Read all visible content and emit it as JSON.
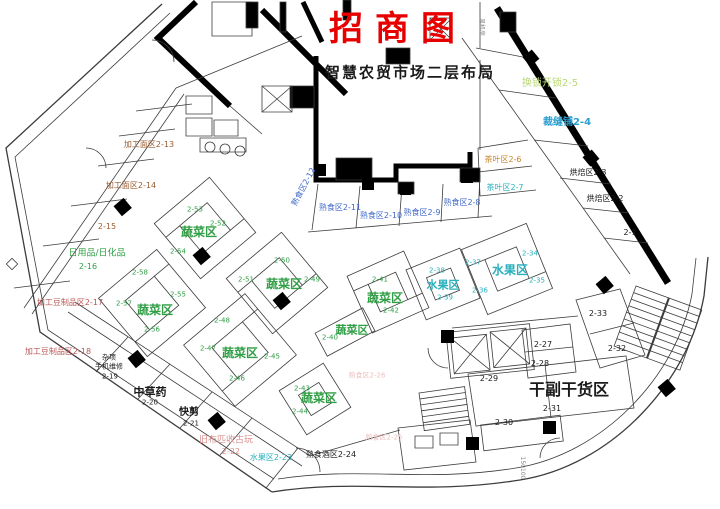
{
  "document": {
    "title": "招商图",
    "subtitle": "智慧农贸市场二层布局",
    "type": "market-floor-plan"
  },
  "colors": {
    "title_red": "#e60000",
    "vegetable_green": "#2f9e44",
    "fruit_cyan": "#29b0bd",
    "cooked_food_blue": "#4069c8",
    "tea_orange": "#c8862a",
    "lockshop_palegreen": "#b9d877",
    "noodle_brown": "#9a5b30",
    "tofu_crimson": "#bb5454",
    "cloth_pink": "#d98f8f",
    "faint_pink": "#eec0c0",
    "ink": "#1a1a1a"
  },
  "labels": [
    {
      "n": "page-title",
      "t": "招商图",
      "x": 398,
      "y": 29,
      "c": "title",
      "s": 34,
      "b": 1,
      "ls": 12
    },
    {
      "n": "page-subtitle",
      "t": "智慧农贸市场二层布局",
      "x": 410,
      "y": 73,
      "c": "dark",
      "s": 15,
      "b": 1,
      "ls": 2
    },
    {
      "n": "shop-2-5",
      "t": "换锁开锁2-5",
      "x": 550,
      "y": 84,
      "c": "palegreen",
      "s": 10
    },
    {
      "n": "shop-2-4",
      "t": "裁缝铺2-4",
      "x": 567,
      "y": 123,
      "c": "cyanb",
      "s": 10,
      "b": 1
    },
    {
      "n": "shop-2-3",
      "t": "烘焙区2-3",
      "x": 588,
      "y": 173,
      "c": "dark",
      "s": 8
    },
    {
      "n": "shop-2-2",
      "t": "烘焙区2-2",
      "x": 605,
      "y": 199,
      "c": "dark",
      "s": 8
    },
    {
      "n": "shop-2-1",
      "t": "2-1",
      "x": 630,
      "y": 233,
      "c": "dark",
      "s": 8
    },
    {
      "n": "shop-2-6",
      "t": "茶叶区2-6",
      "x": 503,
      "y": 160,
      "c": "orange",
      "s": 8
    },
    {
      "n": "shop-2-7",
      "t": "茶叶区2-7",
      "x": 505,
      "y": 188,
      "c": "cyan",
      "s": 8
    },
    {
      "n": "shop-2-8",
      "t": "熟食区2-8",
      "x": 462,
      "y": 203,
      "c": "blue",
      "s": 8
    },
    {
      "n": "shop-2-9",
      "t": "熟食区2-9",
      "x": 422,
      "y": 213,
      "c": "blue",
      "s": 8
    },
    {
      "n": "shop-2-10",
      "t": "熟食区2-10",
      "x": 381,
      "y": 216,
      "c": "blue",
      "s": 8
    },
    {
      "n": "shop-2-11",
      "t": "熟食区2-11",
      "x": 340,
      "y": 208,
      "c": "blue",
      "s": 8
    },
    {
      "n": "shop-2-12",
      "t": "熟食区2-12",
      "x": 304,
      "y": 187,
      "c": "blue",
      "s": 8,
      "r": -62
    },
    {
      "n": "shop-2-13",
      "t": "加工面区2-13",
      "x": 149,
      "y": 145,
      "c": "brown",
      "s": 8
    },
    {
      "n": "shop-2-14",
      "t": "加工面区2-14",
      "x": 131,
      "y": 186,
      "c": "brown",
      "s": 8
    },
    {
      "n": "shop-2-15",
      "t": "2-15",
      "x": 107,
      "y": 227,
      "c": "brown",
      "s": 8
    },
    {
      "n": "zone-daily-goods",
      "t": "日用品/日化品",
      "x": 97,
      "y": 254,
      "c": "green",
      "s": 9
    },
    {
      "n": "shop-2-16",
      "t": "2-16",
      "x": 88,
      "y": 267,
      "c": "green",
      "s": 8
    },
    {
      "n": "shop-2-17",
      "t": "加工豆制品区2-17",
      "x": 70,
      "y": 303,
      "c": "crimson",
      "s": 8
    },
    {
      "n": "shop-2-18",
      "t": "加工豆制品区2-18",
      "x": 58,
      "y": 352,
      "c": "crimson",
      "s": 8
    },
    {
      "n": "shop-2-19-line1",
      "t": "杂项",
      "x": 109,
      "y": 358,
      "c": "dark",
      "s": 7
    },
    {
      "n": "shop-2-19-line2",
      "t": "手机维修",
      "x": 109,
      "y": 367,
      "c": "dark",
      "s": 7
    },
    {
      "n": "shop-2-19-num",
      "t": "2-19",
      "x": 110,
      "y": 377,
      "c": "dark",
      "s": 7
    },
    {
      "n": "zone-herbs",
      "t": "中草药",
      "x": 150,
      "y": 392,
      "c": "dark",
      "s": 11,
      "b": 1
    },
    {
      "n": "shop-2-20-num",
      "t": "2-20",
      "x": 150,
      "y": 403,
      "c": "dark",
      "s": 7
    },
    {
      "n": "zone-haircut",
      "t": "快剪",
      "x": 189,
      "y": 413,
      "c": "dark",
      "s": 10,
      "b": 1
    },
    {
      "n": "shop-2-21-num",
      "t": "2-21",
      "x": 191,
      "y": 424,
      "c": "dark",
      "s": 7
    },
    {
      "n": "shop-2-22-line1",
      "t": "旧布匹收古玩",
      "x": 226,
      "y": 441,
      "c": "pink",
      "s": 9
    },
    {
      "n": "shop-2-22-num",
      "t": "2-22",
      "x": 231,
      "y": 452,
      "c": "pink",
      "s": 8
    },
    {
      "n": "shop-2-23",
      "t": "水果区2-23",
      "x": 271,
      "y": 458,
      "c": "cyan",
      "s": 8
    },
    {
      "n": "shop-2-24",
      "t": "熟食酒区2-24",
      "x": 331,
      "y": 455,
      "c": "dark",
      "s": 8
    },
    {
      "n": "shop-2-25",
      "t": "熟食区2-25",
      "x": 384,
      "y": 438,
      "c": "pinkfaint",
      "s": 7
    },
    {
      "n": "shop-2-26",
      "t": "熟食区2-26",
      "x": 367,
      "y": 376,
      "c": "pinkfaint",
      "s": 7
    },
    {
      "n": "zone-veg-a",
      "t": "蔬菜区",
      "x": 199,
      "y": 232,
      "c": "green",
      "s": 12,
      "b": 1
    },
    {
      "n": "stall-2-53",
      "t": "2-53",
      "x": 195,
      "y": 210,
      "c": "green",
      "s": 7
    },
    {
      "n": "stall-2-52",
      "t": "2-52",
      "x": 218,
      "y": 224,
      "c": "green",
      "s": 7
    },
    {
      "n": "stall-2-54",
      "t": "2-54",
      "x": 178,
      "y": 252,
      "c": "green",
      "s": 7
    },
    {
      "n": "zone-veg-b",
      "t": "蔬菜区",
      "x": 155,
      "y": 310,
      "c": "green",
      "s": 12,
      "b": 1
    },
    {
      "n": "stall-2-58",
      "t": "2-58",
      "x": 140,
      "y": 273,
      "c": "green",
      "s": 7
    },
    {
      "n": "stall-2-55",
      "t": "2-55",
      "x": 178,
      "y": 295,
      "c": "green",
      "s": 7
    },
    {
      "n": "stall-2-57",
      "t": "2-57",
      "x": 124,
      "y": 304,
      "c": "green",
      "s": 7
    },
    {
      "n": "stall-2-56",
      "t": "2-56",
      "x": 152,
      "y": 330,
      "c": "green",
      "s": 7
    },
    {
      "n": "zone-veg-c",
      "t": "蔬菜区",
      "x": 284,
      "y": 284,
      "c": "green",
      "s": 12,
      "b": 1
    },
    {
      "n": "stall-2-50",
      "t": "2-50",
      "x": 282,
      "y": 261,
      "c": "green",
      "s": 7
    },
    {
      "n": "stall-2-51",
      "t": "2-51",
      "x": 246,
      "y": 280,
      "c": "green",
      "s": 7
    },
    {
      "n": "stall-2-49",
      "t": "2-49",
      "x": 312,
      "y": 280,
      "c": "green",
      "s": 7
    },
    {
      "n": "zone-veg-d",
      "t": "蔬菜区",
      "x": 240,
      "y": 353,
      "c": "green",
      "s": 12,
      "b": 1
    },
    {
      "n": "stall-2-48",
      "t": "2-48",
      "x": 222,
      "y": 321,
      "c": "green",
      "s": 7
    },
    {
      "n": "stall-2-47",
      "t": "2-47",
      "x": 208,
      "y": 349,
      "c": "green",
      "s": 7
    },
    {
      "n": "stall-2-45",
      "t": "2-45",
      "x": 272,
      "y": 357,
      "c": "green",
      "s": 7
    },
    {
      "n": "stall-2-46",
      "t": "2-46",
      "x": 237,
      "y": 379,
      "c": "green",
      "s": 7
    },
    {
      "n": "zone-veg-e",
      "t": "蔬菜区",
      "x": 352,
      "y": 330,
      "c": "green",
      "s": 11,
      "b": 1
    },
    {
      "n": "stall-2-40",
      "t": "2-40",
      "x": 330,
      "y": 338,
      "c": "green",
      "s": 7
    },
    {
      "n": "zone-veg-f",
      "t": "蔬菜区",
      "x": 385,
      "y": 298,
      "c": "green",
      "s": 12,
      "b": 1
    },
    {
      "n": "stall-2-41",
      "t": "2-41",
      "x": 380,
      "y": 280,
      "c": "green",
      "s": 7
    },
    {
      "n": "stall-2-42",
      "t": "2-42",
      "x": 391,
      "y": 311,
      "c": "green",
      "s": 7
    },
    {
      "n": "zone-veg-g",
      "t": "蔬菜区",
      "x": 319,
      "y": 398,
      "c": "green",
      "s": 12,
      "b": 1
    },
    {
      "n": "stall-2-43",
      "t": "2-43",
      "x": 302,
      "y": 389,
      "c": "green",
      "s": 7
    },
    {
      "n": "stall-2-44",
      "t": "2-44",
      "x": 300,
      "y": 412,
      "c": "green",
      "s": 7
    },
    {
      "n": "zone-fruit-left",
      "t": "水果区",
      "x": 443,
      "y": 285,
      "c": "cyan",
      "s": 11,
      "b": 1
    },
    {
      "n": "stall-2-38",
      "t": "2-38",
      "x": 437,
      "y": 271,
      "c": "cyan",
      "s": 7
    },
    {
      "n": "stall-2-39",
      "t": "2-39",
      "x": 445,
      "y": 298,
      "c": "cyan",
      "s": 7
    },
    {
      "n": "zone-fruit-right",
      "t": "水果区",
      "x": 510,
      "y": 270,
      "c": "cyan",
      "s": 12,
      "b": 1
    },
    {
      "n": "stall-2-34",
      "t": "2-34",
      "x": 530,
      "y": 254,
      "c": "cyan",
      "s": 7
    },
    {
      "n": "stall-2-37",
      "t": "2-37",
      "x": 473,
      "y": 263,
      "c": "cyan",
      "s": 7
    },
    {
      "n": "stall-2-35",
      "t": "2-35",
      "x": 537,
      "y": 281,
      "c": "cyan",
      "s": 7
    },
    {
      "n": "stall-2-36",
      "t": "2-36",
      "x": 480,
      "y": 291,
      "c": "cyan",
      "s": 7
    },
    {
      "n": "stall-2-33",
      "t": "2-33",
      "x": 598,
      "y": 314,
      "c": "dark",
      "s": 8
    },
    {
      "n": "stall-2-32",
      "t": "2-32",
      "x": 617,
      "y": 349,
      "c": "dark",
      "s": 8
    },
    {
      "n": "stall-2-27",
      "t": "2-27",
      "x": 543,
      "y": 345,
      "c": "dark",
      "s": 8
    },
    {
      "n": "stall-2-28",
      "t": "2-28",
      "x": 540,
      "y": 364,
      "c": "dark",
      "s": 8
    },
    {
      "n": "stall-2-29",
      "t": "2-29",
      "x": 489,
      "y": 379,
      "c": "dark",
      "s": 8
    },
    {
      "n": "zone-dry-goods",
      "t": "干副干货区",
      "x": 569,
      "y": 390,
      "c": "dark",
      "s": 16,
      "b": 1
    },
    {
      "n": "stall-2-31",
      "t": "2-31",
      "x": 552,
      "y": 409,
      "c": "dark",
      "s": 8
    },
    {
      "n": "stall-2-30",
      "t": "2-30",
      "x": 504,
      "y": 423,
      "c": "dark",
      "s": 8
    },
    {
      "n": "dimension-text",
      "t": "150100",
      "x": 522,
      "y": 468,
      "c": "gray",
      "s": 6,
      "r": 90
    },
    {
      "n": "room-fan",
      "t": "风机房",
      "x": 481,
      "y": 27,
      "c": "gray",
      "s": 6,
      "r": 90
    }
  ]
}
